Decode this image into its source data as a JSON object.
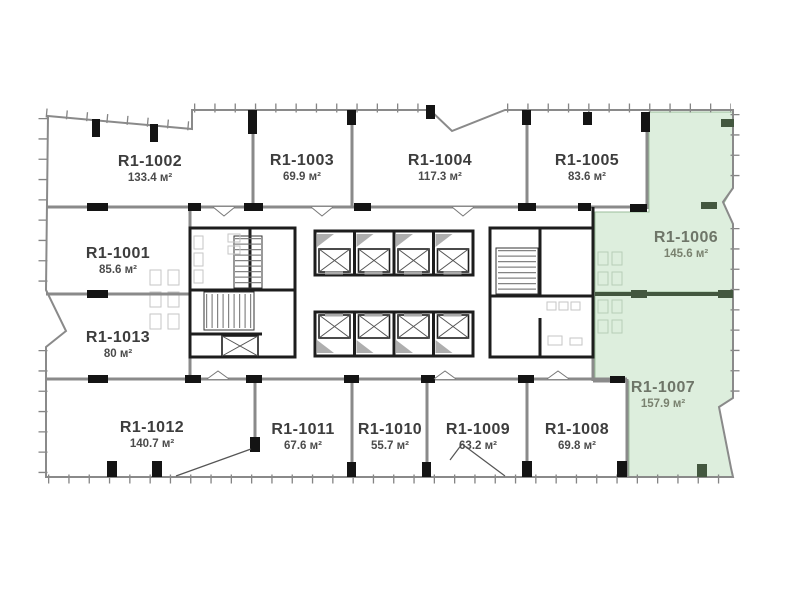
{
  "floor_plan": {
    "units_label": "м²",
    "highlighted_units": [
      "R1-1006",
      "R1-1007"
    ],
    "rooms": [
      {
        "id": "R1-1001",
        "area": "85.6 м²",
        "highlighted": false
      },
      {
        "id": "R1-1002",
        "area": "133.4 м²",
        "highlighted": false
      },
      {
        "id": "R1-1003",
        "area": "69.9 м²",
        "highlighted": false
      },
      {
        "id": "R1-1004",
        "area": "117.3 м²",
        "highlighted": false
      },
      {
        "id": "R1-1005",
        "area": "83.6 м²",
        "highlighted": false
      },
      {
        "id": "R1-1006",
        "area": "145.6 м²",
        "highlighted": true
      },
      {
        "id": "R1-1007",
        "area": "157.9 м²",
        "highlighted": true
      },
      {
        "id": "R1-1008",
        "area": "69.8 м²",
        "highlighted": false
      },
      {
        "id": "R1-1009",
        "area": "63.2 м²",
        "highlighted": false
      },
      {
        "id": "R1-1010",
        "area": "55.7 м²",
        "highlighted": false
      },
      {
        "id": "R1-1011",
        "area": "67.6 м²",
        "highlighted": false
      },
      {
        "id": "R1-1012",
        "area": "140.7 м²",
        "highlighted": false
      },
      {
        "id": "R1-1013",
        "area": "80 м²",
        "highlighted": false
      }
    ]
  },
  "colors": {
    "highlight_fill": "#ddeedd",
    "highlight_wall": "#43573f",
    "wall": "#8a8a8a",
    "core_wall": "#1d1d1d",
    "pier": "#141414",
    "tick": "#7d7d7d",
    "label": "#3d3d3d",
    "area_label": "#4b4b4b",
    "label_highlight": "#6e7568",
    "area_label_highlight": "#79816f",
    "fixture": "#c6c6c6"
  }
}
